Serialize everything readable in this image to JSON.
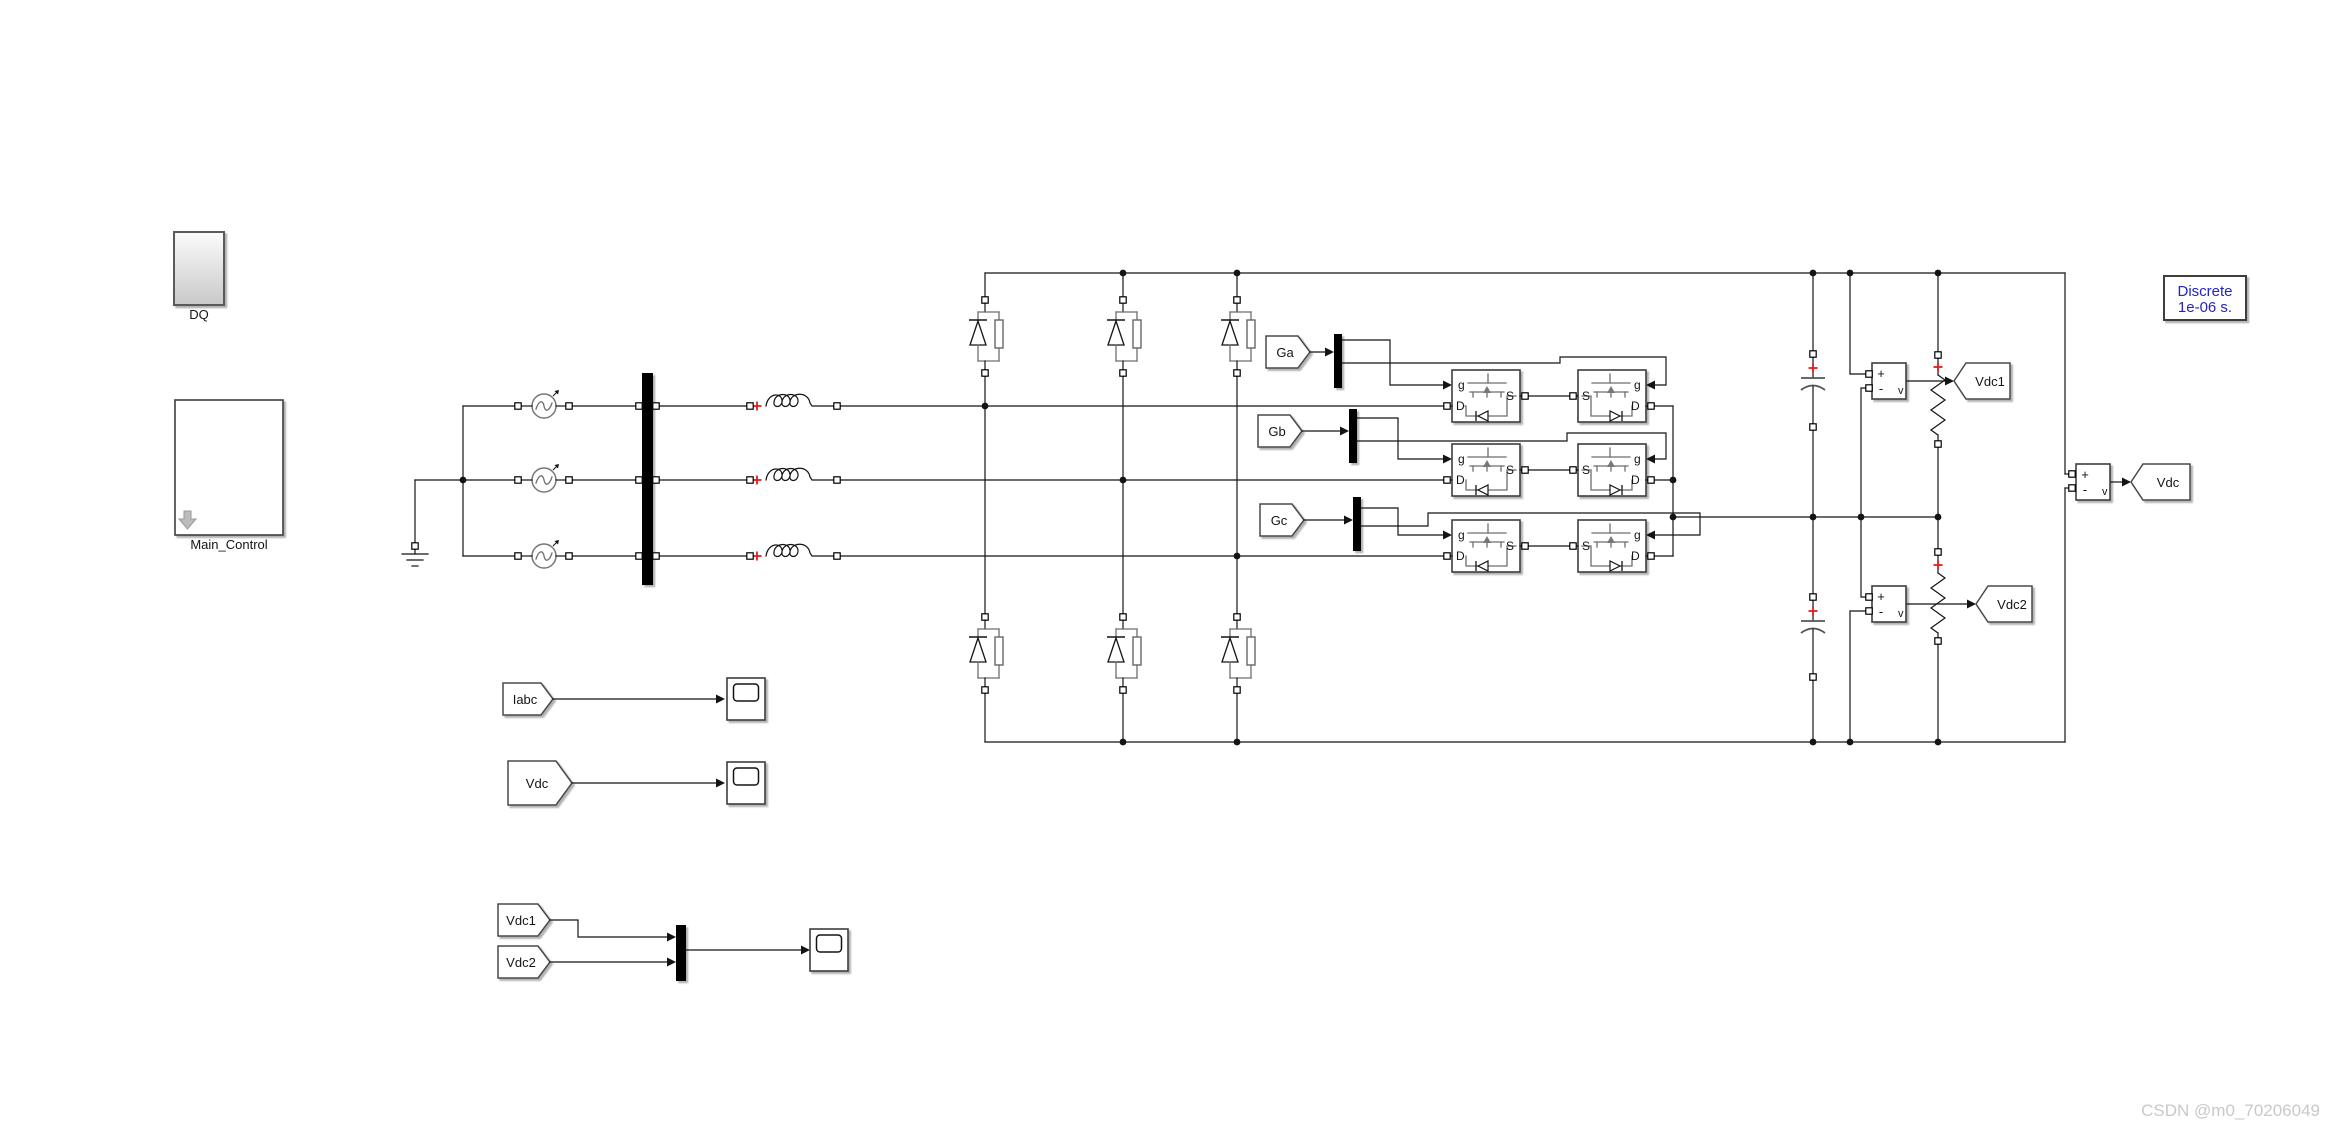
{
  "labels": {
    "dq": "DQ",
    "main_control": "Main_Control",
    "ga": "Ga",
    "gb": "Gb",
    "gc": "Gc",
    "g": "g",
    "d": "D",
    "s": "S",
    "plus": "+",
    "minus": "-",
    "v": "v",
    "goto_vdc1": "Vdc1",
    "goto_vdc2": "Vdc2",
    "goto_vdc": "Vdc",
    "from_iabc": "Iabc",
    "from_vdc": "Vdc",
    "from_vdc1": "Vdc1",
    "from_vdc2": "Vdc2",
    "powergui_line1": "Discrete",
    "powergui_line2": "1e-06 s."
  },
  "watermark": "CSDN @m0_70206049",
  "colors": {
    "background": "#ffffff",
    "wire": "#141414",
    "polarity_mark": "#e02020",
    "powergui_text": "#2323c9",
    "block_fill": "#ffffff",
    "bus_bar": "#000000",
    "watermark": "#c9c9c9"
  }
}
